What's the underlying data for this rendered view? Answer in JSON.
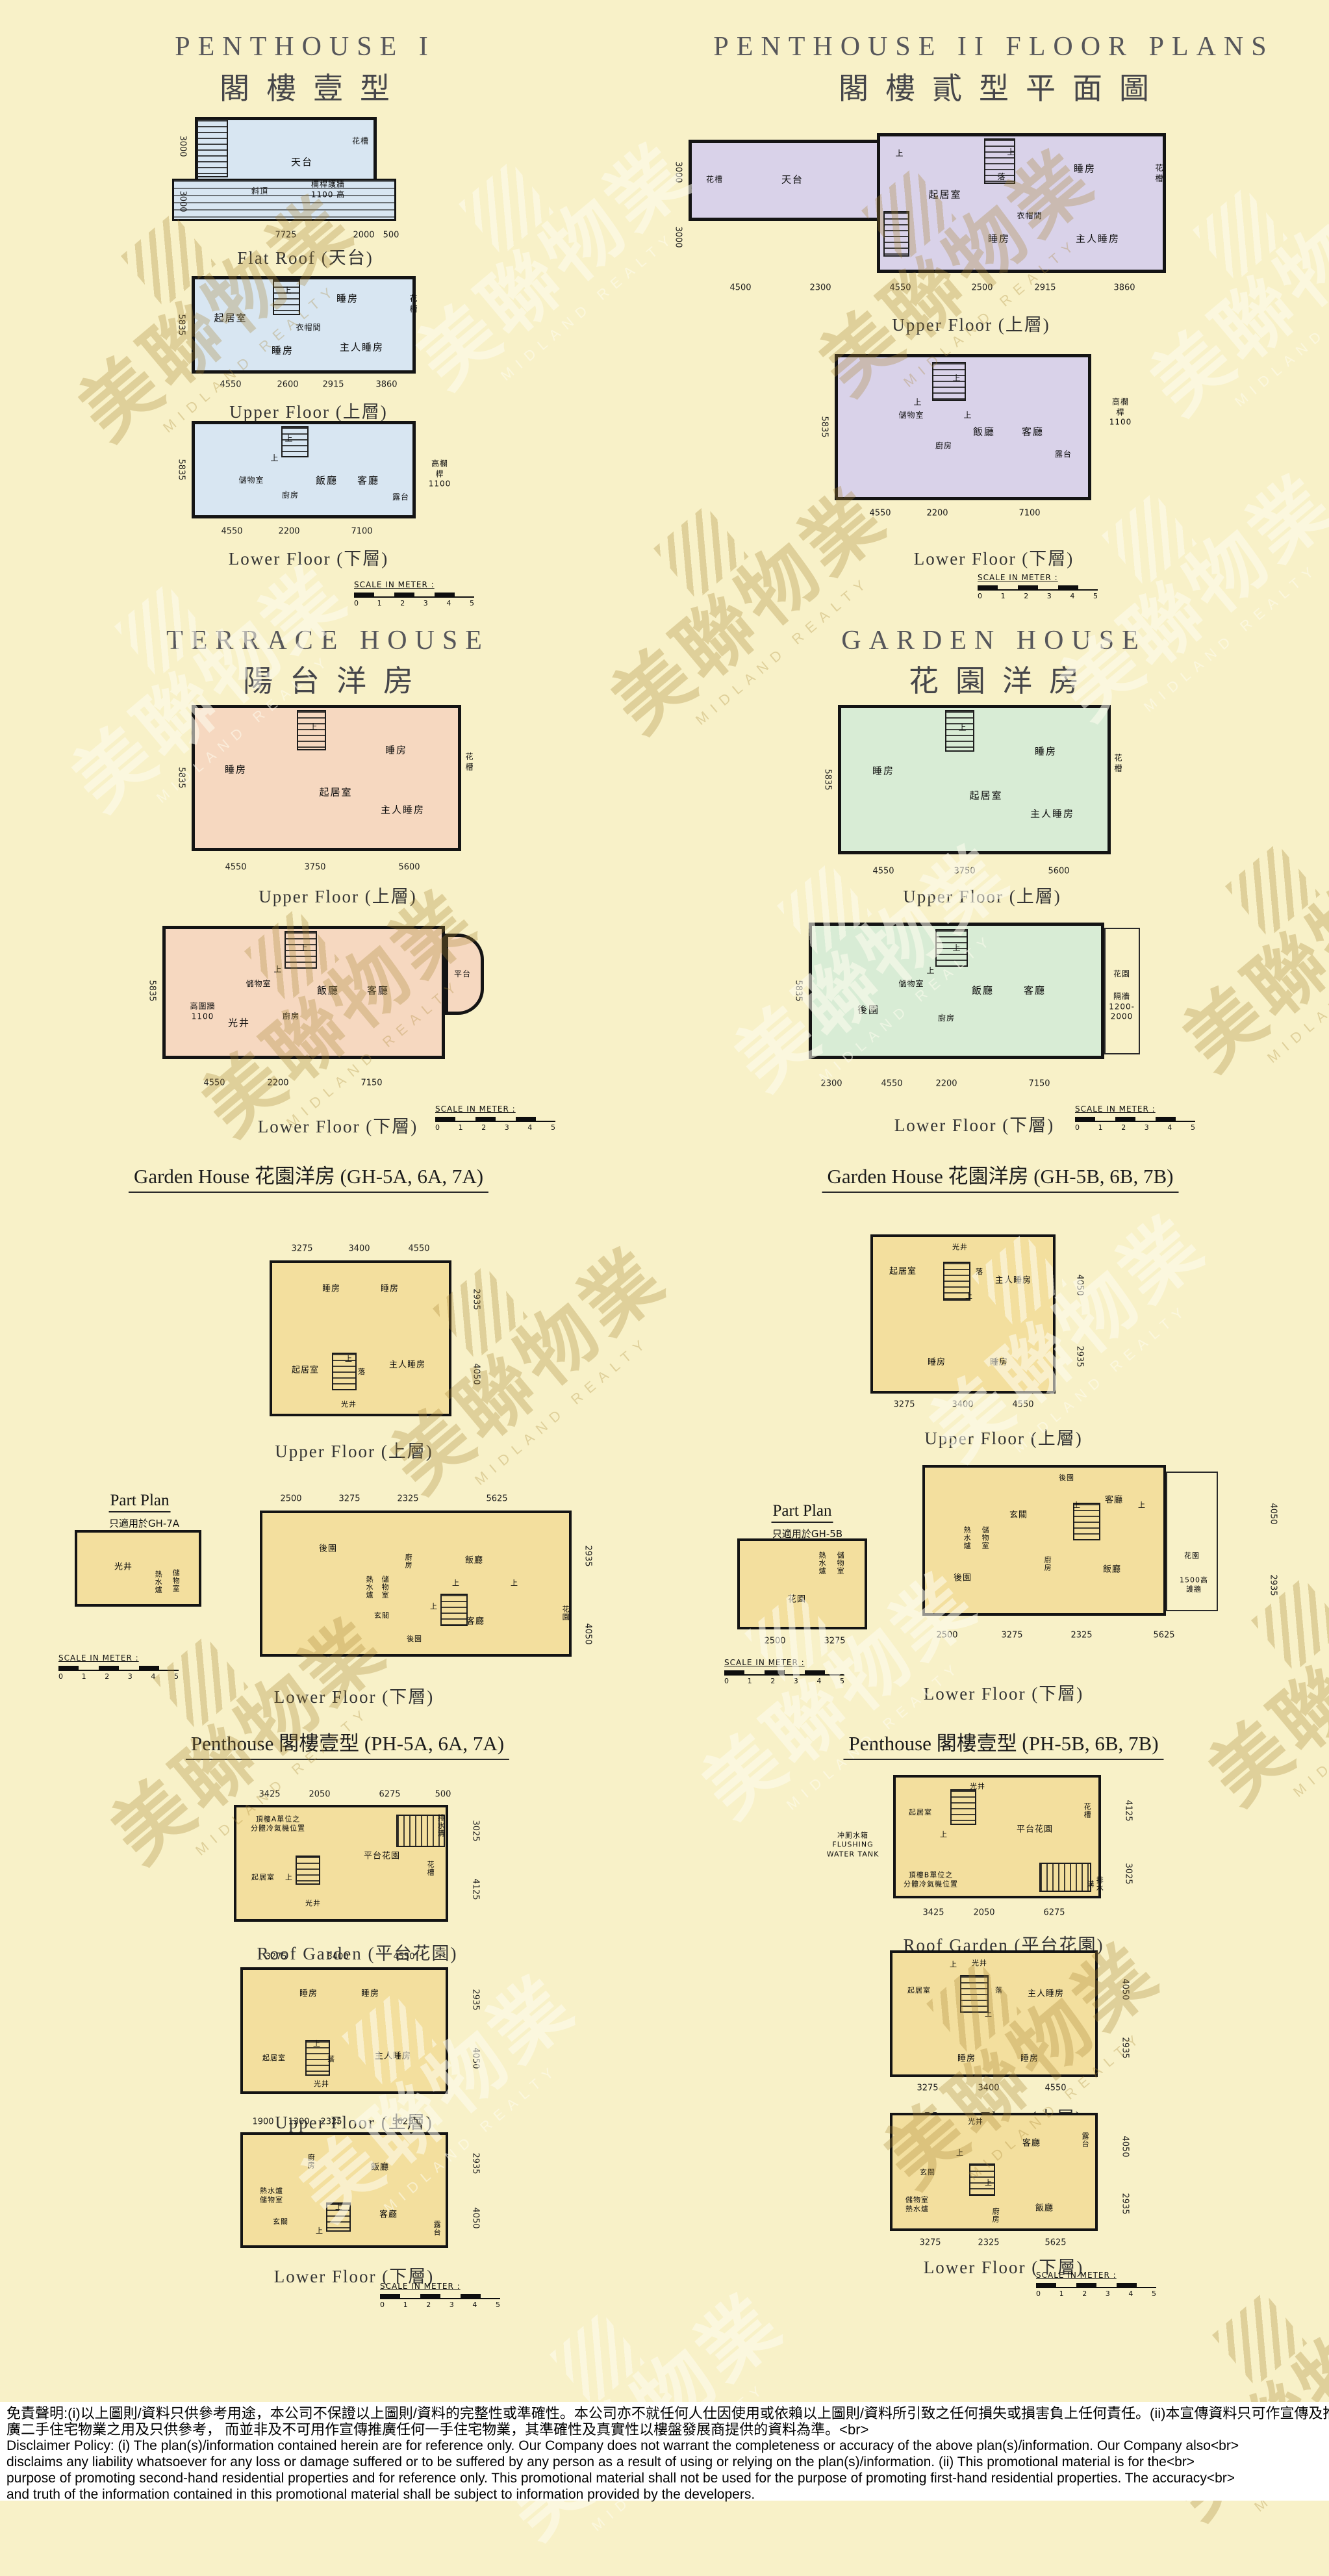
{
  "watermark": {
    "zh": "美聯物業",
    "en": "MIDLAND REALTY"
  },
  "scale": {
    "label": "SCALE IN METER :",
    "ticks": [
      "0",
      "1",
      "2",
      "3",
      "4",
      "5"
    ]
  },
  "captions": {
    "flat_roof": "Flat Roof (天台)",
    "upper": "Upper Floor (上層)",
    "lower": "Lower Floor (下層)",
    "roof_garden": "Roof Garden (平台花園)",
    "part_plan": "Part Plan"
  },
  "colors": {
    "page_bg": "#f8f1c8",
    "penthouse1_fill": "#d8e6f2",
    "penthouse2_fill": "#d9d2e9",
    "terrace_fill": "#f6d8c0",
    "garden_fill": "#d8ecd5",
    "unit_plans_fill": "#f3df9e",
    "wall": "#141414",
    "watermark_tan": "#a98634"
  },
  "sections": {
    "ph1": {
      "en": "PENTHOUSE I",
      "zh": "閣樓壹型"
    },
    "ph2": {
      "en": "PENTHOUSE II FLOOR PLANS",
      "zh": "閣樓貳型平面圖"
    },
    "th": {
      "en": "TERRACE HOUSE",
      "zh": "陽台洋房"
    },
    "gh": {
      "en": "GARDEN HOUSE",
      "zh": "花園洋房"
    },
    "gh5a": {
      "title": "Garden House 花園洋房 (GH-5A, 6A, 7A)",
      "part_note": "只適用於GH-7A"
    },
    "gh5b": {
      "title": "Garden House 花園洋房 (GH-5B, 6B, 7B)",
      "part_note": "只適用於GH-5B"
    },
    "ph5a": {
      "title": "Penthouse 閣樓壹型 (PH-5A, 6A, 7A)"
    },
    "ph5b": {
      "title": "Penthouse 閣樓壹型 (PH-5B, 6B, 7B)"
    }
  },
  "plans": {
    "ph1_flat": {
      "labels": [
        "天台",
        "花槽",
        "斜頂",
        "欄桿護牆\n1100 高"
      ],
      "dims": [
        "7725",
        "2000",
        "500",
        "3000",
        "3000"
      ]
    },
    "ph1_up": {
      "labels": [
        "起居室",
        "上",
        "睡房",
        "花槽",
        "衣帽間",
        "睡房",
        "主人睡房"
      ],
      "dims": [
        "4550",
        "2600",
        "2915",
        "3860",
        "5835"
      ]
    },
    "ph1_lo": {
      "labels": [
        "上",
        "上",
        "儲物室",
        "廚房",
        "飯廳",
        "客廳",
        "露台",
        "高欄桿\n1100"
      ],
      "dims": [
        "4550",
        "2200",
        "7100",
        "5835"
      ]
    },
    "ph2_up": {
      "labels": [
        "花槽",
        "天台",
        "上",
        "起居室",
        "落",
        "上",
        "睡房",
        "花槽",
        "衣帽間",
        "睡房",
        "主人睡房"
      ],
      "dims": [
        "4500",
        "2300",
        "4550",
        "2500",
        "2915",
        "3860",
        "3000",
        "3000"
      ]
    },
    "ph2_lo": {
      "labels": [
        "上",
        "上",
        "上",
        "儲物室",
        "廚房",
        "飯廳",
        "客廳",
        "露台",
        "高欄桿\n1100"
      ],
      "dims": [
        "4550",
        "2200",
        "7100",
        "5835"
      ]
    },
    "th_up": {
      "labels": [
        "睡房",
        "上",
        "睡房",
        "花槽",
        "起居室",
        "主人睡房"
      ],
      "dims": [
        "4550",
        "3750",
        "5600",
        "5835"
      ]
    },
    "th_lo": {
      "labels": [
        "上",
        "上",
        "儲物室",
        "飯廳",
        "客廳",
        "平台",
        "廚房",
        "光井",
        "高圍牆\n1100"
      ],
      "dims": [
        "4550",
        "2200",
        "7150",
        "5835"
      ]
    },
    "gh_up": {
      "labels": [
        "睡房",
        "上",
        "睡房",
        "花槽",
        "起居室",
        "主人睡房"
      ],
      "dims": [
        "4550",
        "3750",
        "5600",
        "5835"
      ]
    },
    "gh_lo": {
      "labels": [
        "後園",
        "上",
        "上",
        "儲物室",
        "飯廳",
        "客廳",
        "廚房",
        "花園",
        "隔牆\n1200-2000"
      ],
      "dims": [
        "2300",
        "4550",
        "2200",
        "7150",
        "5835"
      ]
    },
    "g5a_up": {
      "labels": [
        "睡房",
        "睡房",
        "起居室",
        "上",
        "落",
        "主人睡房",
        "光井"
      ],
      "dims": [
        "3275",
        "3400",
        "4550",
        "2935",
        "4050"
      ]
    },
    "g5a_part": {
      "labels": [
        "光井",
        "熱水爐",
        "儲物室"
      ],
      "dims": []
    },
    "g5a_lo": {
      "labels": [
        "後園",
        "廚房",
        "飯廳",
        "熱水爐",
        "儲物室",
        "玄關",
        "客廳",
        "後園",
        "花園",
        "上",
        "上",
        "上"
      ],
      "dims": [
        "2500",
        "3275",
        "2325",
        "5625",
        "2935",
        "4050"
      ]
    },
    "p5a_roof": {
      "labels": [
        "頂樓A單位之\n分體冷氣機位置",
        "排水溝",
        "平台花園",
        "花槽",
        "起居室",
        "上",
        "光井"
      ],
      "dims": [
        "3425",
        "2050",
        "6275",
        "500",
        "3025",
        "4125"
      ]
    },
    "p5a_up": {
      "labels": [
        "睡房",
        "睡房",
        "起居室",
        "上",
        "落",
        "主人睡房",
        "光井"
      ],
      "dims": [
        "3275",
        "3400",
        "4550",
        "2935",
        "4050"
      ]
    },
    "p5a_lo": {
      "labels": [
        "廚房",
        "飯廳",
        "熱水爐\n儲物室",
        "玄關",
        "客廳",
        "露台",
        "上",
        "上"
      ],
      "dims": [
        "1900",
        "1300",
        "2325",
        "5625",
        "2935",
        "4050"
      ]
    },
    "g5b_up": {
      "labels": [
        "起居室",
        "光井",
        "落",
        "上",
        "主人睡房",
        "睡房",
        "睡房"
      ],
      "dims": [
        "3275",
        "3400",
        "4550",
        "4050",
        "2935"
      ]
    },
    "g5b_part": {
      "labels": [
        "熱水爐",
        "儲物室",
        "花園"
      ],
      "dims": [
        "2500",
        "3275"
      ]
    },
    "g5b_lo": {
      "labels": [
        "後園",
        "玄關",
        "客廳",
        "熱水爐",
        "儲物室",
        "廚房",
        "後園",
        "飯廳",
        "花園",
        "1500高\n護牆",
        "上",
        "上"
      ],
      "dims": [
        "2500",
        "3275",
        "2325",
        "5625",
        "4050",
        "2935"
      ]
    },
    "p5b_roof": {
      "labels": [
        "起居室",
        "上",
        "光井",
        "平台花園",
        "花槽",
        "排水溝",
        "頂樓B單位之\n分體冷氣機位置",
        "冲厠水箱\nFLUSHING\nWATER TANK"
      ],
      "dims": [
        "3425",
        "2050",
        "6275",
        "4125",
        "3025"
      ]
    },
    "p5b_up": {
      "labels": [
        "起居室",
        "上",
        "落",
        "上",
        "光井",
        "主人睡房",
        "睡房",
        "睡房"
      ],
      "dims": [
        "3275",
        "3400",
        "4550",
        "4050",
        "2935"
      ]
    },
    "p5b_lo": {
      "labels": [
        "玄關",
        "客廳",
        "露台",
        "光井",
        "儲物室\n熱水爐",
        "廚房",
        "飯廳",
        "上",
        "上"
      ],
      "dims": [
        "3275",
        "2325",
        "5625",
        "4050",
        "2935"
      ]
    }
  },
  "disclaimer": {
    "lines": [
      "免責聲明:(i)以上圖則/資料只供參考用途，本公司不保證以上圖則/資料的完整性或準確性。本公司亦不就任何人仕因使用或依賴以上圖則/資料所引致之任何損失或損害負上任何責任。(ii)本宣傳資料只可作宣傳及推<br>",
      "廣二手住宅物業之用及只供參考， 而並非及不可用作宣傳推廣任何一手住宅物業，其準確性及真實性以樓盤發展商提供的資料為準。<br>",
      "Disclaimer Policy: (i) The plan(s)/information contained herein are for reference only. Our Company does not warrant the completeness or accuracy of the above plan(s)/information. Our Company also<br>",
      "disclaims any liability whatsoever for any loss or damage suffered or to be suffered by any person as a result of using or relying on the plan(s)/information. (ii) This promotional material is for the<br>",
      "purpose of promoting second-hand residential properties and for reference only. This promotional material shall not be used for the purpose of promoting first-hand residential properties. The accuracy<br>",
      "and truth of the information contained in this promotional material shall be subject to information provided by the developers."
    ]
  }
}
